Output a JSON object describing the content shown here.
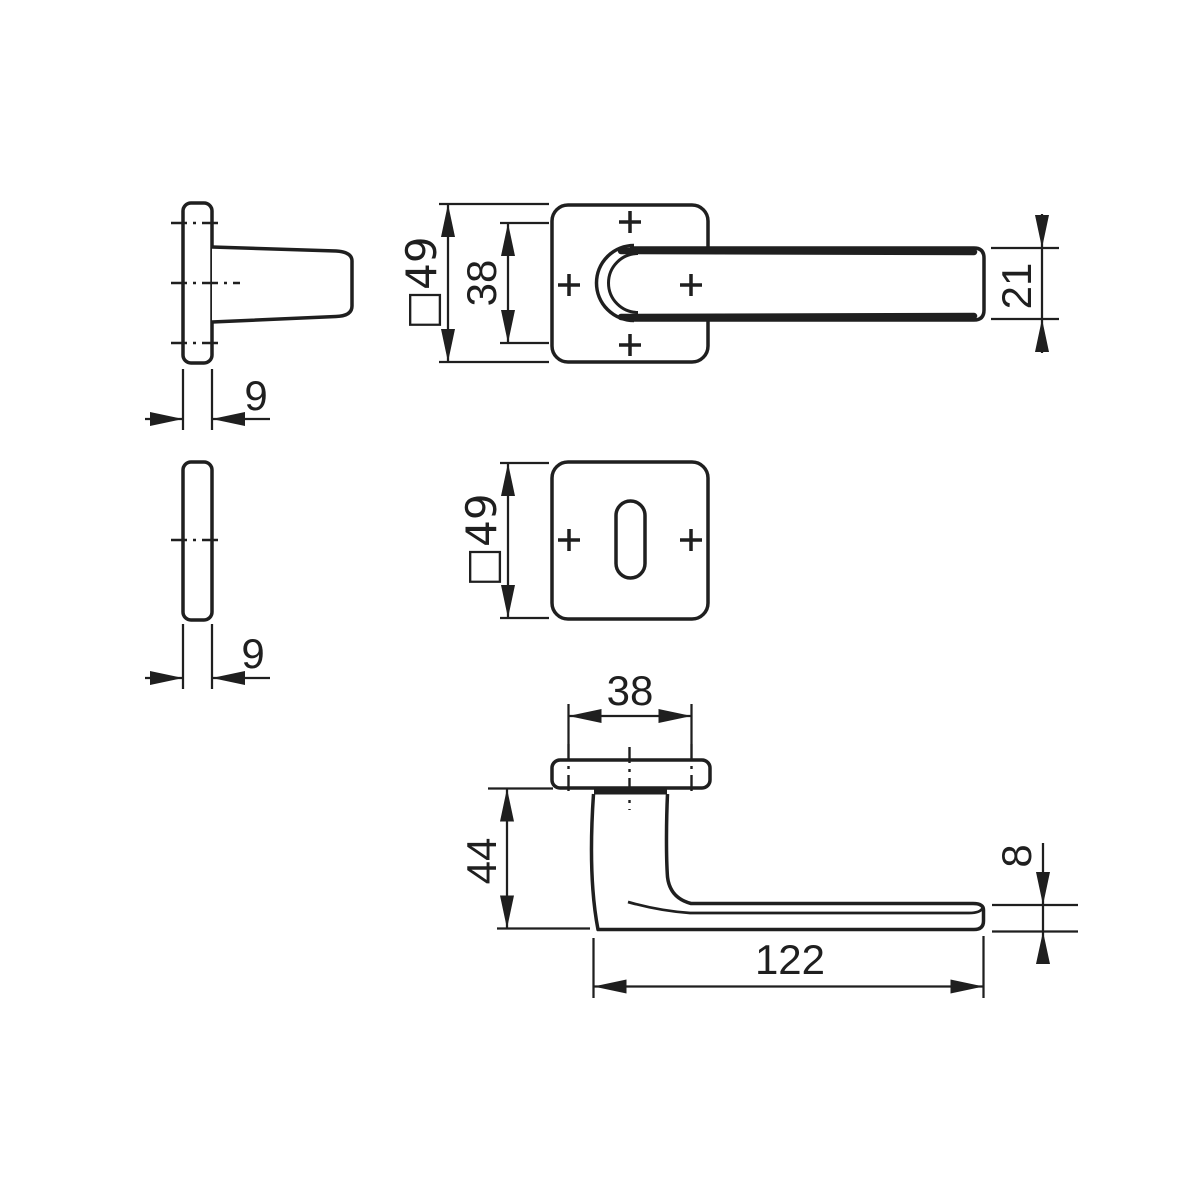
{
  "title": "Door handle set technical dimension drawing",
  "colors": {
    "line": "#1f1f1f",
    "background": "#ffffff"
  },
  "views": {
    "handle_rose_side": {
      "thickness": "9"
    },
    "handle_front": {
      "rose_square": "□49",
      "neck_width": "38",
      "grip_width": "21"
    },
    "key_rose_side": {
      "thickness": "9"
    },
    "key_rose_front": {
      "rose_square": "□49"
    },
    "handle_profile": {
      "neck_width": "38",
      "projection": "44",
      "grip_thickness": "8",
      "length": "122"
    }
  }
}
